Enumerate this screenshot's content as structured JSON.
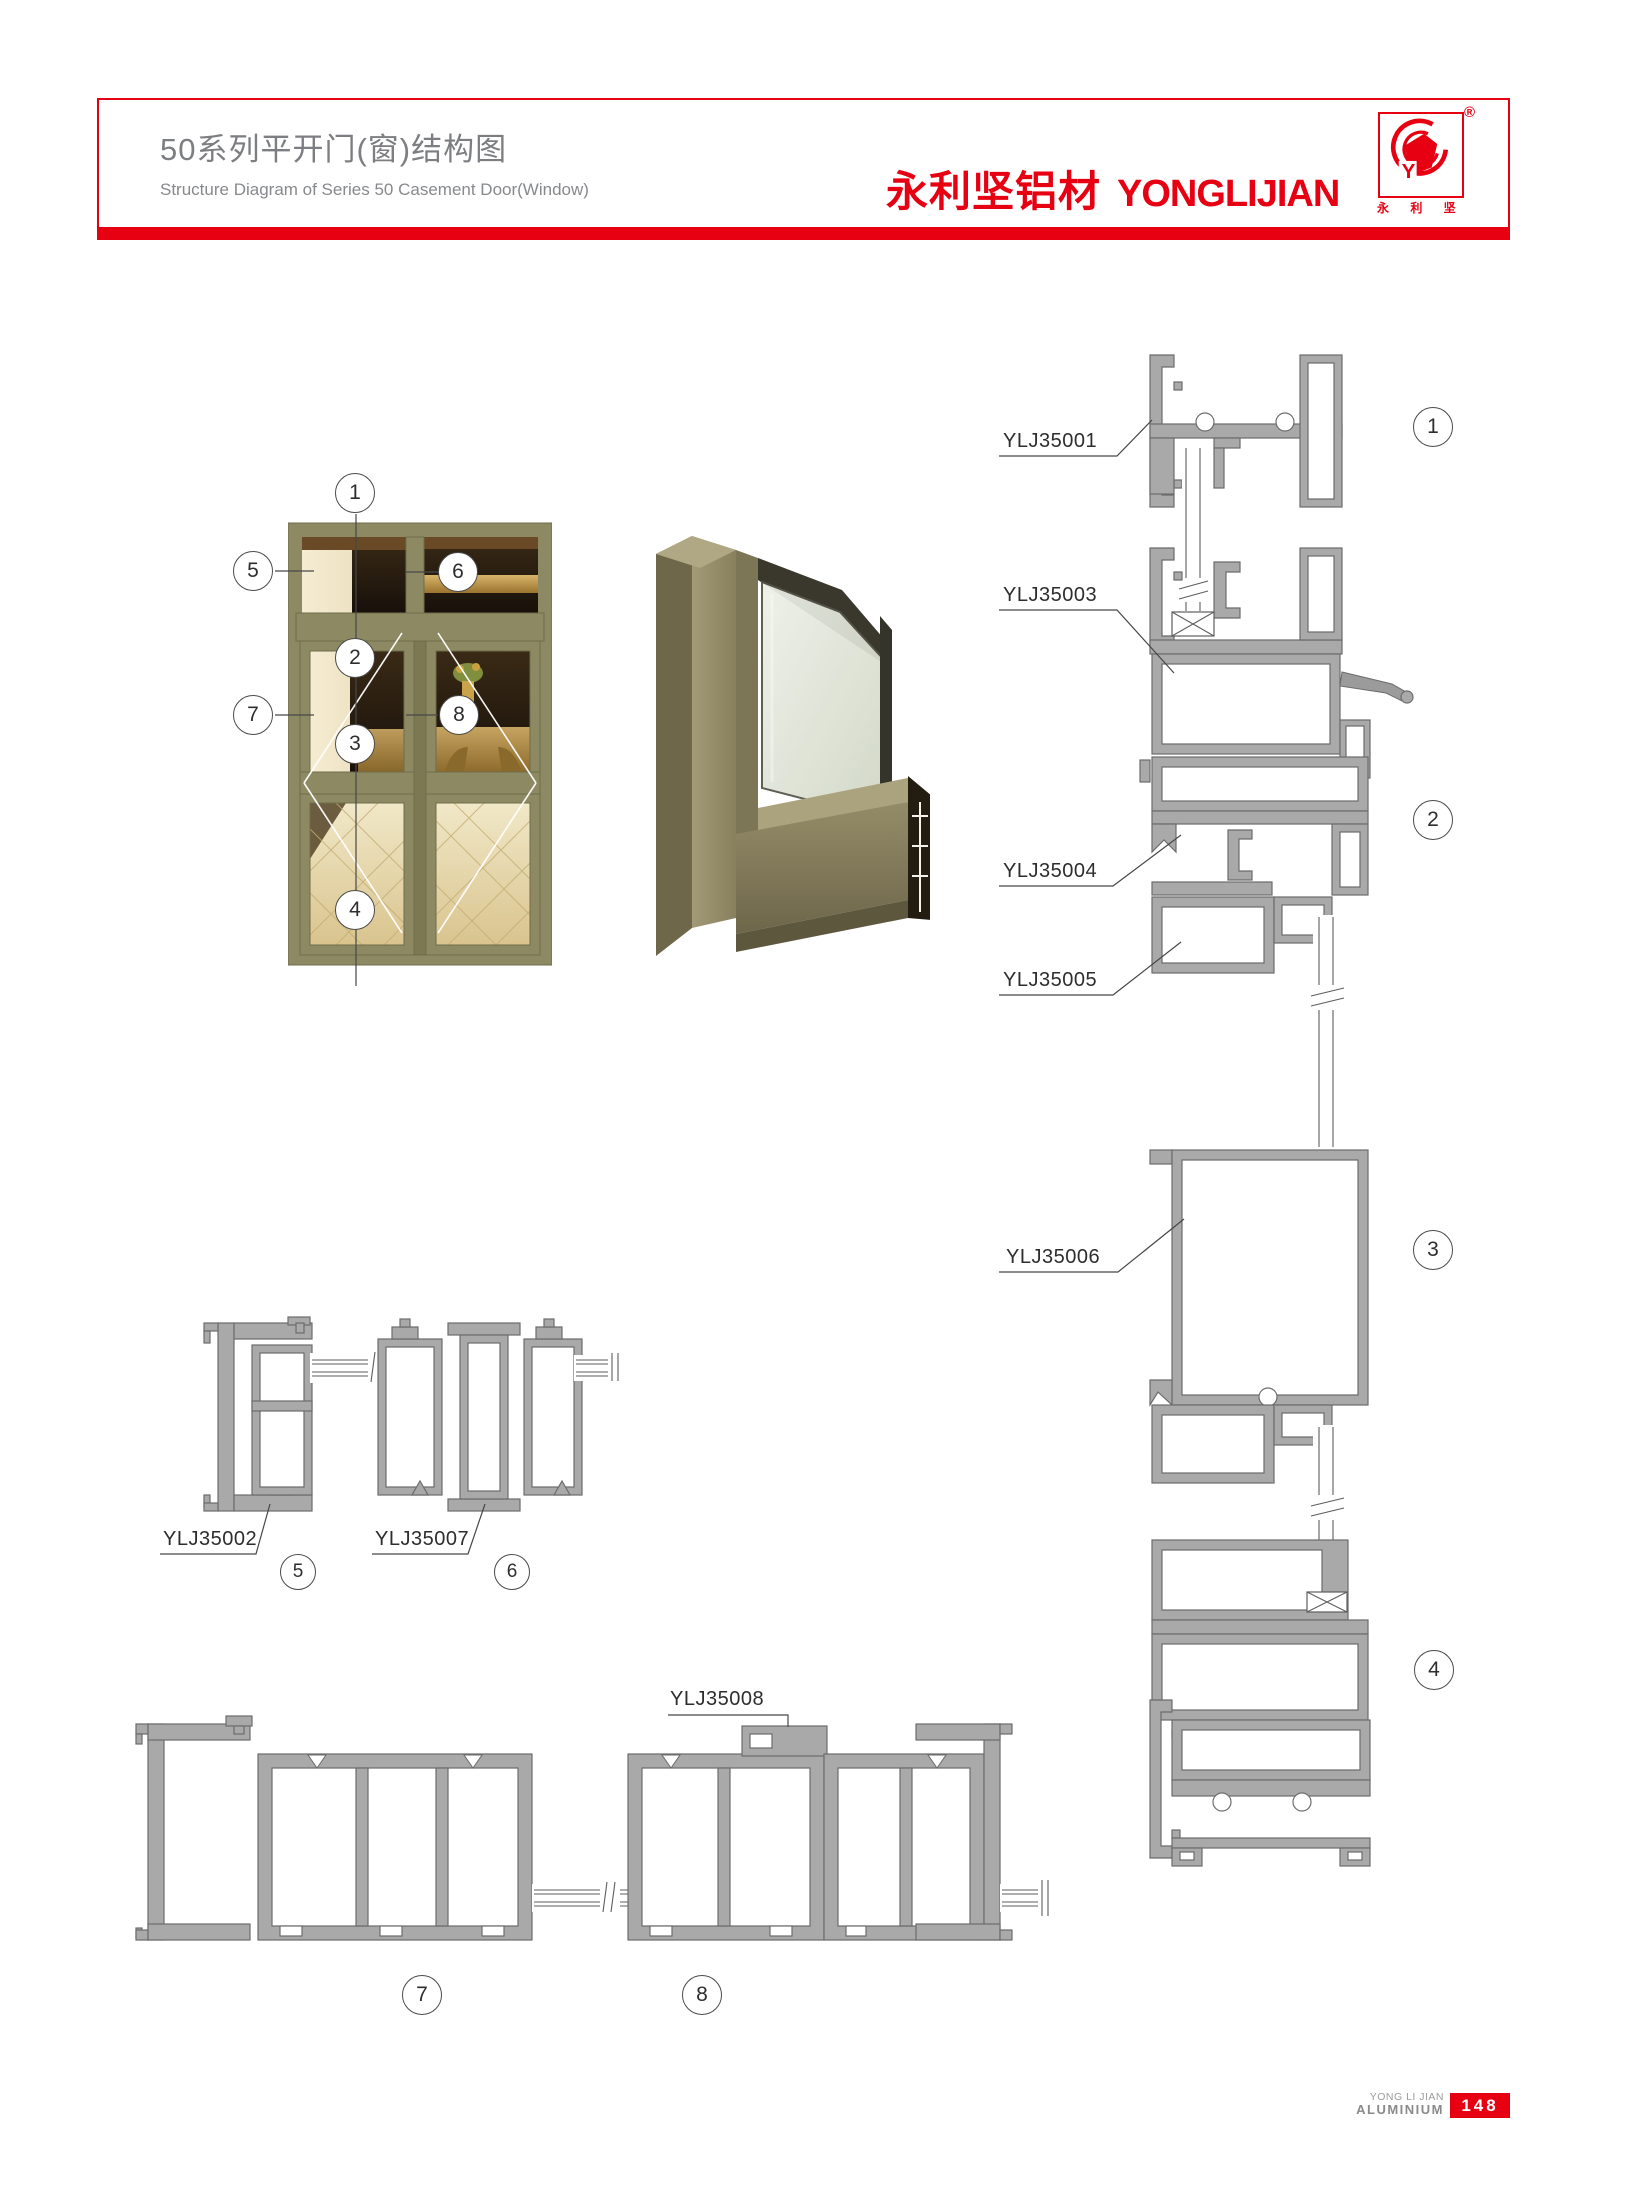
{
  "header": {
    "title_cn": "50系列平开门(窗)结构图",
    "title_en": "Structure Diagram of Series 50 Casement Door(Window)",
    "brand_cn": "永利坚铝材",
    "brand_en": "YONGLIJIAN",
    "trademark": "®",
    "logo_y": "Y",
    "logo_caption": "永 利 坚",
    "accent_color": "#e60012"
  },
  "callouts": {
    "c1": "1",
    "c2": "2",
    "c3": "3",
    "c4": "4",
    "c5": "5",
    "c6": "6",
    "c7": "7",
    "c8": "8"
  },
  "part_labels": {
    "p35001": "YLJ35001",
    "p35002": "YLJ35002",
    "p35003": "YLJ35003",
    "p35004": "YLJ35004",
    "p35005": "YLJ35005",
    "p35006": "YLJ35006",
    "p35007": "YLJ35007",
    "p35008": "YLJ35008"
  },
  "footer": {
    "brand_line1": "YONG LI JIAN",
    "brand_line2": "ALUMINIUM",
    "page_number": "148"
  }
}
